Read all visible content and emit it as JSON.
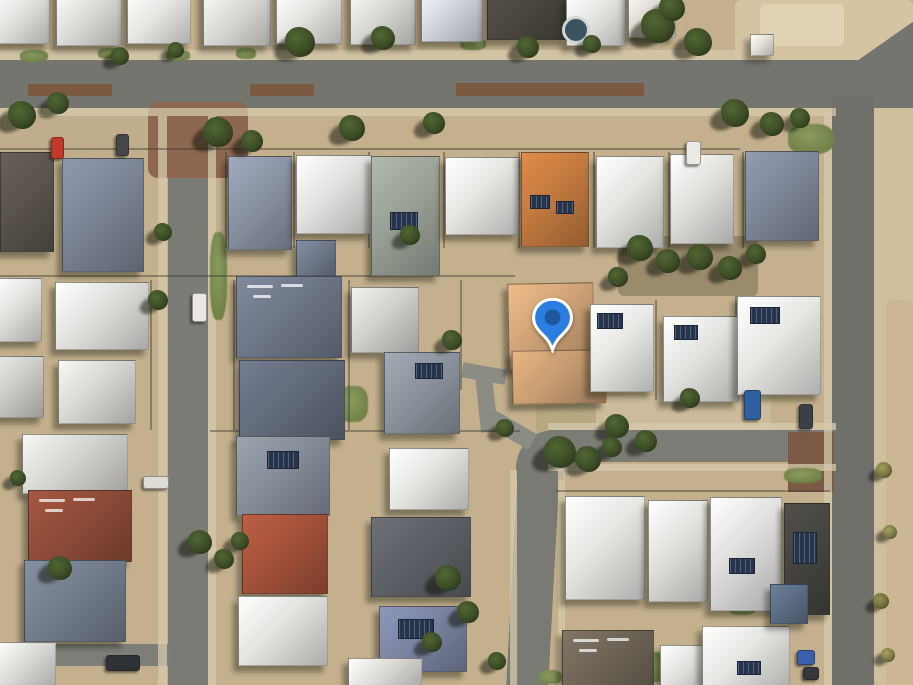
{
  "map": {
    "description": "satellite-aerial-view-residential-neighbourhood",
    "canvas": {
      "w": 913,
      "h": 685
    },
    "pin": {
      "tip_x": 552,
      "tip_y": 353,
      "w": 47,
      "h": 56,
      "head_color": "#2b7de2",
      "dot_color": "#1d579c",
      "stroke_color": "#ffffff"
    }
  },
  "scene": {
    "ground_base": "#c4b08d",
    "ground_patches": [
      {
        "x": 735,
        "y": 0,
        "w": 178,
        "h": 64,
        "c": "#d4c4a2"
      },
      {
        "x": 760,
        "y": 4,
        "w": 84,
        "h": 42,
        "c": "#e0d2b2"
      },
      {
        "x": 874,
        "y": 64,
        "w": 39,
        "h": 621,
        "c": "#d0bf9c"
      },
      {
        "x": 886,
        "y": 300,
        "w": 27,
        "h": 385,
        "c": "#cbb794"
      },
      {
        "x": 536,
        "y": 384,
        "w": 88,
        "h": 58,
        "c": "#b8a982"
      },
      {
        "x": 596,
        "y": 396,
        "w": 175,
        "h": 38,
        "c": "#cdbc9b"
      },
      {
        "x": 0,
        "y": 112,
        "w": 150,
        "h": 62,
        "c": "#c0ad8c"
      },
      {
        "x": 618,
        "y": 236,
        "w": 140,
        "h": 60,
        "c": "#9b8b6d"
      }
    ],
    "roads": [
      {
        "x": 0,
        "y": 60,
        "w": 913,
        "h": 48,
        "c": "#74756e"
      },
      {
        "x": 848,
        "y": 42,
        "w": 86,
        "h": 44,
        "c": "#74756e",
        "rot": -35
      },
      {
        "x": 168,
        "y": 106,
        "w": 40,
        "h": 579,
        "c": "#7a7b74"
      },
      {
        "x": 832,
        "y": 96,
        "w": 42,
        "h": 589,
        "c": "#6f706a"
      },
      {
        "x": 548,
        "y": 430,
        "w": 286,
        "h": 32,
        "c": "#7b7c75"
      },
      {
        "x": 516,
        "y": 430,
        "w": 48,
        "h": 50,
        "c": "#7b7c75",
        "rtl": 38
      },
      {
        "x": 518,
        "y": 462,
        "w": 42,
        "h": 223,
        "c": "#797a73",
        "skew": -3
      },
      {
        "x": 462,
        "y": 366,
        "w": 44,
        "h": 15,
        "c": "#8b8c84",
        "rot": 10
      },
      {
        "x": 478,
        "y": 374,
        "w": 17,
        "h": 58,
        "c": "#8b8c84",
        "rot": -6
      },
      {
        "x": 484,
        "y": 420,
        "w": 52,
        "h": 18,
        "c": "#8b8c84",
        "rot": 30
      },
      {
        "x": 0,
        "y": 644,
        "w": 170,
        "h": 22,
        "c": "#7d7e77"
      },
      {
        "x": 148,
        "y": 102,
        "w": 100,
        "h": 76,
        "c": "#8d6750",
        "rad": 10
      },
      {
        "x": 788,
        "y": 432,
        "w": 46,
        "h": 60,
        "c": "#7d5a46"
      },
      {
        "x": 28,
        "y": 84,
        "w": 84,
        "h": 12,
        "c": "#7c5a42"
      },
      {
        "x": 250,
        "y": 84,
        "w": 64,
        "h": 12,
        "c": "#7c5a42"
      },
      {
        "x": 456,
        "y": 83,
        "w": 188,
        "h": 13,
        "c": "#7c5a42"
      }
    ],
    "sidewalks": [
      {
        "x": 0,
        "y": 50,
        "w": 742,
        "h": 10
      },
      {
        "x": 0,
        "y": 108,
        "w": 836,
        "h": 8
      },
      {
        "x": 158,
        "y": 116,
        "w": 9,
        "h": 569
      },
      {
        "x": 208,
        "y": 116,
        "w": 8,
        "h": 569
      },
      {
        "x": 824,
        "y": 112,
        "w": 8,
        "h": 573
      },
      {
        "x": 548,
        "y": 423,
        "w": 288,
        "h": 7
      },
      {
        "x": 548,
        "y": 464,
        "w": 288,
        "h": 7
      },
      {
        "x": 510,
        "y": 470,
        "w": 7,
        "h": 215
      },
      {
        "x": 558,
        "y": 470,
        "w": 7,
        "h": 215
      }
    ],
    "grass": [
      {
        "x": 20,
        "y": 50,
        "w": 28,
        "h": 12
      },
      {
        "x": 98,
        "y": 48,
        "w": 22,
        "h": 11
      },
      {
        "x": 166,
        "y": 50,
        "w": 24,
        "h": 11
      },
      {
        "x": 236,
        "y": 48,
        "w": 20,
        "h": 11
      },
      {
        "x": 460,
        "y": 38,
        "w": 26,
        "h": 12
      },
      {
        "x": 210,
        "y": 232,
        "w": 17,
        "h": 88
      },
      {
        "x": 788,
        "y": 124,
        "w": 46,
        "h": 30
      },
      {
        "x": 338,
        "y": 386,
        "w": 30,
        "h": 36
      },
      {
        "x": 784,
        "y": 468,
        "w": 38,
        "h": 15
      },
      {
        "x": 538,
        "y": 670,
        "w": 24,
        "h": 14
      },
      {
        "x": 728,
        "y": 598,
        "w": 28,
        "h": 17
      },
      {
        "x": 650,
        "y": 652,
        "w": 13,
        "h": 30
      }
    ],
    "fences": [
      {
        "x": 0,
        "y": 148,
        "w": 740,
        "h": 2
      },
      {
        "x": 0,
        "y": 275,
        "w": 515,
        "h": 2
      },
      {
        "x": 210,
        "y": 430,
        "w": 310,
        "h": 2
      },
      {
        "x": 556,
        "y": 490,
        "w": 274,
        "h": 2
      },
      {
        "x": 225,
        "y": 152,
        "w": 2,
        "h": 96
      },
      {
        "x": 293,
        "y": 152,
        "w": 2,
        "h": 96
      },
      {
        "x": 368,
        "y": 152,
        "w": 2,
        "h": 96
      },
      {
        "x": 443,
        "y": 152,
        "w": 2,
        "h": 96
      },
      {
        "x": 518,
        "y": 152,
        "w": 2,
        "h": 96
      },
      {
        "x": 593,
        "y": 152,
        "w": 2,
        "h": 96
      },
      {
        "x": 668,
        "y": 152,
        "w": 2,
        "h": 96
      },
      {
        "x": 742,
        "y": 152,
        "w": 2,
        "h": 96
      },
      {
        "x": 150,
        "y": 280,
        "w": 2,
        "h": 150
      },
      {
        "x": 233,
        "y": 280,
        "w": 2,
        "h": 150
      },
      {
        "x": 348,
        "y": 280,
        "w": 2,
        "h": 150
      },
      {
        "x": 460,
        "y": 280,
        "w": 2,
        "h": 110
      },
      {
        "x": 655,
        "y": 300,
        "w": 2,
        "h": 100
      },
      {
        "x": 735,
        "y": 296,
        "w": 2,
        "h": 100
      }
    ],
    "houses": [
      {
        "x": -8,
        "y": -10,
        "w": 56,
        "h": 52,
        "c": "#e2e2df"
      },
      {
        "x": 56,
        "y": -12,
        "w": 64,
        "h": 56,
        "c": "#dcdcd8"
      },
      {
        "x": 127,
        "y": -10,
        "w": 62,
        "h": 52,
        "c": "#e6e6e3"
      },
      {
        "x": 203,
        "y": -12,
        "w": 66,
        "h": 56,
        "c": "#dadad6"
      },
      {
        "x": 276,
        "y": -10,
        "w": 64,
        "h": 52,
        "c": "#e3e3e0"
      },
      {
        "x": 350,
        "y": -12,
        "w": 64,
        "h": 55,
        "c": "#d8d8d4"
      },
      {
        "x": 421,
        "y": -10,
        "w": 60,
        "h": 50,
        "c": "#cfd4da"
      },
      {
        "x": 487,
        "y": -14,
        "w": 78,
        "h": 52,
        "c": "#4b473f"
      },
      {
        "x": 566,
        "y": -4,
        "w": 58,
        "h": 48,
        "c": "#e4e4e1"
      },
      {
        "x": 628,
        "y": -10,
        "w": 46,
        "h": 46,
        "c": "#dddad4"
      },
      {
        "x": 750,
        "y": 34,
        "w": 22,
        "h": 20,
        "c": "#e4e0d6"
      },
      {
        "x": 0,
        "y": 152,
        "w": 52,
        "h": 98,
        "c": "#59544c"
      },
      {
        "x": 62,
        "y": 158,
        "w": 80,
        "h": 112,
        "c": "#7b8495"
      },
      {
        "x": 228,
        "y": 156,
        "w": 62,
        "h": 92,
        "c": "#8a93a3"
      },
      {
        "x": 296,
        "y": 155,
        "w": 74,
        "h": 77,
        "c": "#e1e2df"
      },
      {
        "x": 371,
        "y": 156,
        "w": 67,
        "h": 118,
        "c": "#99a095",
        "solar": [
          [
            18,
            55,
            26,
            16
          ]
        ]
      },
      {
        "x": 445,
        "y": 157,
        "w": 72,
        "h": 76,
        "c": "#e6e6e3"
      },
      {
        "x": 521,
        "y": 152,
        "w": 66,
        "h": 93,
        "c": "#c1793f",
        "solar": [
          [
            8,
            42,
            18,
            12
          ],
          [
            34,
            48,
            16,
            11
          ]
        ]
      },
      {
        "x": 596,
        "y": 156,
        "w": 66,
        "h": 90,
        "c": "#e3e3e0"
      },
      {
        "x": 670,
        "y": 154,
        "w": 62,
        "h": 88,
        "c": "#dfdfdc"
      },
      {
        "x": 745,
        "y": 151,
        "w": 72,
        "h": 88,
        "c": "#7e8798"
      },
      {
        "x": 296,
        "y": 240,
        "w": 38,
        "h": 34,
        "c": "#707a8b"
      },
      {
        "x": -6,
        "y": 278,
        "w": 46,
        "h": 62,
        "c": "#e0e0dd"
      },
      {
        "x": 55,
        "y": 282,
        "w": 92,
        "h": 66,
        "c": "#dfdfdc"
      },
      {
        "x": 58,
        "y": 360,
        "w": 76,
        "h": 62,
        "c": "#d6d6d2"
      },
      {
        "x": -6,
        "y": 356,
        "w": 48,
        "h": 60,
        "c": "#cbcbc7"
      },
      {
        "x": 236,
        "y": 276,
        "w": 104,
        "h": 80,
        "c": "#6e7787",
        "marks": true
      },
      {
        "x": 239,
        "y": 360,
        "w": 104,
        "h": 78,
        "c": "#636c7c"
      },
      {
        "x": 351,
        "y": 287,
        "w": 66,
        "h": 64,
        "c": "#d0d1cd"
      },
      {
        "x": 384,
        "y": 352,
        "w": 74,
        "h": 80,
        "c": "#8c939d",
        "solar": [
          [
            30,
            10,
            26,
            14
          ]
        ]
      },
      {
        "x": 508,
        "y": 283,
        "w": 84,
        "h": 84,
        "c": "#cea276",
        "rot": -1
      },
      {
        "x": 512,
        "y": 350,
        "w": 92,
        "h": 52,
        "c": "#c89d72",
        "rot": -1
      },
      {
        "x": 590,
        "y": 304,
        "w": 62,
        "h": 86,
        "c": "#e7e7e4",
        "solar": [
          [
            6,
            8,
            24,
            14
          ]
        ]
      },
      {
        "x": 663,
        "y": 316,
        "w": 74,
        "h": 84,
        "c": "#e3e3e0",
        "solar": [
          [
            10,
            8,
            22,
            13
          ]
        ]
      },
      {
        "x": 737,
        "y": 296,
        "w": 82,
        "h": 97,
        "c": "#e6e6e3",
        "solar": [
          [
            12,
            10,
            28,
            15
          ]
        ]
      },
      {
        "x": 22,
        "y": 434,
        "w": 104,
        "h": 58,
        "c": "#d4d5d1"
      },
      {
        "x": 28,
        "y": 490,
        "w": 102,
        "h": 70,
        "c": "#8e4c39",
        "marks": true
      },
      {
        "x": 24,
        "y": 560,
        "w": 100,
        "h": 80,
        "c": "#737d8c"
      },
      {
        "x": -6,
        "y": 642,
        "w": 60,
        "h": 46,
        "c": "#dcdcd9"
      },
      {
        "x": 236,
        "y": 436,
        "w": 92,
        "h": 78,
        "c": "#868d98",
        "solar": [
          [
            30,
            14,
            30,
            16
          ]
        ]
      },
      {
        "x": 242,
        "y": 514,
        "w": 84,
        "h": 78,
        "c": "#a3523a"
      },
      {
        "x": 238,
        "y": 596,
        "w": 88,
        "h": 68,
        "c": "#e2e2df"
      },
      {
        "x": 389,
        "y": 448,
        "w": 78,
        "h": 60,
        "c": "#e4e4e1"
      },
      {
        "x": 371,
        "y": 517,
        "w": 98,
        "h": 78,
        "c": "#5d6166"
      },
      {
        "x": 379,
        "y": 606,
        "w": 86,
        "h": 64,
        "c": "#7a84a0",
        "solar": [
          [
            18,
            12,
            34,
            18
          ]
        ]
      },
      {
        "x": 348,
        "y": 658,
        "w": 72,
        "h": 30,
        "c": "#dddcd8"
      },
      {
        "x": 565,
        "y": 496,
        "w": 78,
        "h": 102,
        "c": "#e5e5e2"
      },
      {
        "x": 648,
        "y": 500,
        "w": 58,
        "h": 100,
        "c": "#e0e0dd"
      },
      {
        "x": 710,
        "y": 497,
        "w": 70,
        "h": 112,
        "c": "#dddddb",
        "solar": [
          [
            18,
            60,
            24,
            14
          ]
        ]
      },
      {
        "x": 784,
        "y": 503,
        "w": 44,
        "h": 110,
        "c": "#46443f",
        "solar": [
          [
            8,
            28,
            22,
            30
          ]
        ]
      },
      {
        "x": 562,
        "y": 630,
        "w": 90,
        "h": 58,
        "c": "#6f6557",
        "marks": true
      },
      {
        "x": 660,
        "y": 645,
        "w": 56,
        "h": 42,
        "c": "#e1e1de"
      },
      {
        "x": 702,
        "y": 626,
        "w": 86,
        "h": 60,
        "c": "#e6e6e3",
        "solar": [
          [
            34,
            34,
            22,
            12
          ]
        ]
      },
      {
        "x": 770,
        "y": 584,
        "w": 36,
        "h": 38,
        "c": "#5c6e85"
      }
    ],
    "pool": {
      "x": 562,
      "y": 16,
      "w": 22,
      "h": 22,
      "c": "#3a545f",
      "ring": "#cfd6d2"
    },
    "trees": [
      {
        "x": 300,
        "y": 42,
        "r": 15
      },
      {
        "x": 383,
        "y": 38,
        "r": 12
      },
      {
        "x": 528,
        "y": 47,
        "r": 11
      },
      {
        "x": 592,
        "y": 44,
        "r": 9
      },
      {
        "x": 658,
        "y": 26,
        "r": 17
      },
      {
        "x": 698,
        "y": 42,
        "r": 14
      },
      {
        "x": 672,
        "y": 8,
        "r": 13
      },
      {
        "x": 120,
        "y": 56,
        "r": 9
      },
      {
        "x": 176,
        "y": 50,
        "r": 8
      },
      {
        "x": 22,
        "y": 115,
        "r": 14
      },
      {
        "x": 58,
        "y": 103,
        "r": 11
      },
      {
        "x": 218,
        "y": 132,
        "r": 15
      },
      {
        "x": 252,
        "y": 141,
        "r": 11
      },
      {
        "x": 352,
        "y": 128,
        "r": 13
      },
      {
        "x": 434,
        "y": 123,
        "r": 11
      },
      {
        "x": 735,
        "y": 113,
        "r": 14
      },
      {
        "x": 772,
        "y": 124,
        "r": 12
      },
      {
        "x": 800,
        "y": 118,
        "r": 10
      },
      {
        "x": 640,
        "y": 248,
        "r": 13
      },
      {
        "x": 668,
        "y": 261,
        "r": 12
      },
      {
        "x": 700,
        "y": 257,
        "r": 13
      },
      {
        "x": 730,
        "y": 268,
        "r": 12
      },
      {
        "x": 756,
        "y": 254,
        "r": 10
      },
      {
        "x": 618,
        "y": 277,
        "r": 10
      },
      {
        "x": 410,
        "y": 235,
        "r": 10
      },
      {
        "x": 452,
        "y": 340,
        "r": 10
      },
      {
        "x": 158,
        "y": 300,
        "r": 10
      },
      {
        "x": 163,
        "y": 232,
        "r": 9
      },
      {
        "x": 560,
        "y": 452,
        "r": 16
      },
      {
        "x": 588,
        "y": 459,
        "r": 13
      },
      {
        "x": 612,
        "y": 447,
        "r": 10
      },
      {
        "x": 505,
        "y": 428,
        "r": 9
      },
      {
        "x": 617,
        "y": 426,
        "r": 12
      },
      {
        "x": 646,
        "y": 441,
        "r": 11
      },
      {
        "x": 690,
        "y": 398,
        "r": 10
      },
      {
        "x": 200,
        "y": 542,
        "r": 12
      },
      {
        "x": 224,
        "y": 559,
        "r": 10
      },
      {
        "x": 240,
        "y": 541,
        "r": 9
      },
      {
        "x": 60,
        "y": 568,
        "r": 12
      },
      {
        "x": 18,
        "y": 478,
        "r": 8
      },
      {
        "x": 448,
        "y": 578,
        "r": 13
      },
      {
        "x": 468,
        "y": 612,
        "r": 11
      },
      {
        "x": 432,
        "y": 642,
        "r": 10
      },
      {
        "x": 497,
        "y": 661,
        "r": 9
      },
      {
        "x": 884,
        "y": 470,
        "r": 8,
        "c": "#77753f"
      },
      {
        "x": 890,
        "y": 532,
        "r": 7,
        "c": "#7a7844"
      },
      {
        "x": 881,
        "y": 601,
        "r": 8,
        "c": "#6f6d3c"
      },
      {
        "x": 888,
        "y": 655,
        "r": 7,
        "c": "#7a7844"
      }
    ],
    "cars": [
      {
        "x": 51,
        "y": 137,
        "w": 11,
        "h": 20,
        "c": "#c0392b"
      },
      {
        "x": 116,
        "y": 134,
        "w": 11,
        "h": 20,
        "c": "#43464b"
      },
      {
        "x": 192,
        "y": 293,
        "w": 13,
        "h": 27,
        "c": "#e9e7e1"
      },
      {
        "x": 686,
        "y": 141,
        "w": 13,
        "h": 22,
        "c": "#eceae4"
      },
      {
        "x": 744,
        "y": 390,
        "w": 15,
        "h": 28,
        "c": "#2f5f9e"
      },
      {
        "x": 799,
        "y": 404,
        "w": 12,
        "h": 23,
        "c": "#3c3f45"
      },
      {
        "x": 106,
        "y": 655,
        "w": 32,
        "h": 14,
        "c": "#2e3136"
      },
      {
        "x": 143,
        "y": 476,
        "w": 24,
        "h": 11,
        "c": "#dedcd5"
      },
      {
        "x": 797,
        "y": 650,
        "w": 16,
        "h": 13,
        "c": "#3a5fae"
      },
      {
        "x": 803,
        "y": 667,
        "w": 14,
        "h": 11,
        "c": "#33363b"
      }
    ]
  }
}
